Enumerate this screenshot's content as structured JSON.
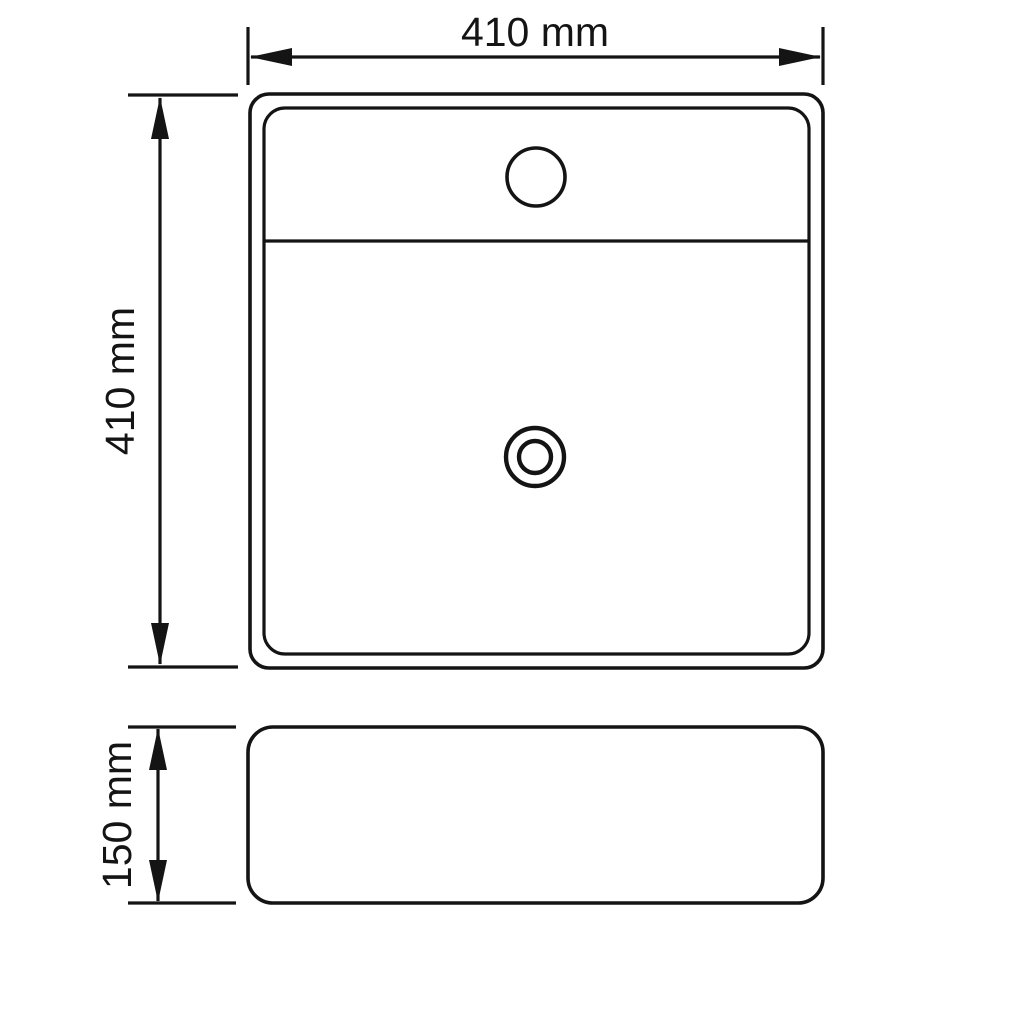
{
  "page": {
    "background_color": "#ffffff",
    "line_color": "#141414"
  },
  "drawing": {
    "subject": "washbasin-technical-drawing",
    "dimensions": {
      "width": {
        "label": "410 mm",
        "value": 410,
        "unit": "mm"
      },
      "depth": {
        "label": "410 mm",
        "value": 410,
        "unit": "mm"
      },
      "height": {
        "label": "150 mm",
        "value": 150,
        "unit": "mm"
      }
    }
  }
}
